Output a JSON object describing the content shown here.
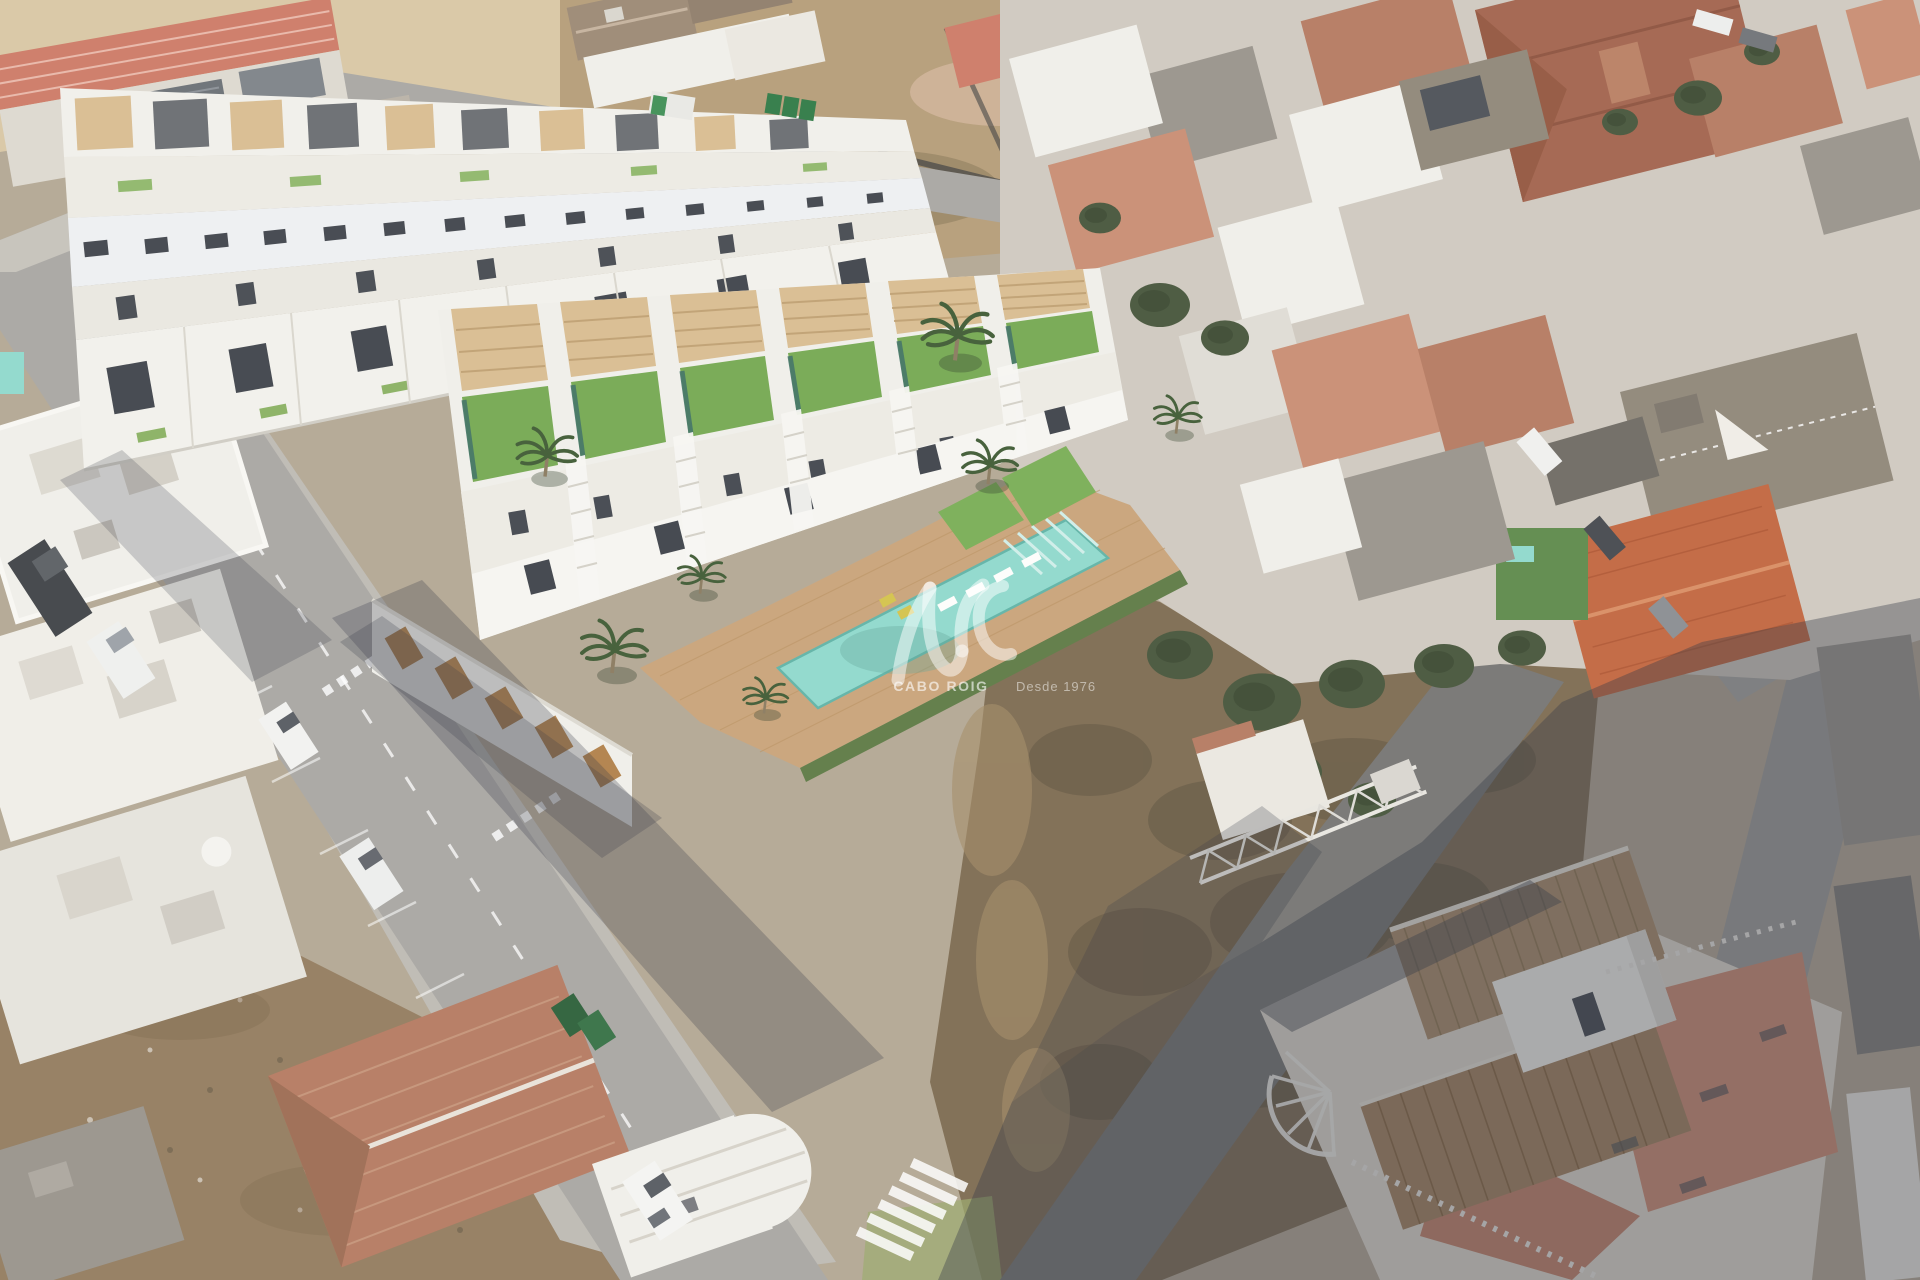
{
  "watermark": {
    "monogram": "AVS",
    "brand": "CABO ROIG",
    "since": "Desde 1976"
  },
  "scene": {
    "description": "Aerial composite: 3D render of a new white townhouse development with green roofs, communal pool and wooden sun deck, inserted into an aerial photo of an existing Spanish coastal town with terracotta roofs, asphalt streets, parked cars, empty dirt plots and palm trees.",
    "new_townhouse_units": 6,
    "pools_visible": 2,
    "palm_trees": 7
  },
  "palette": {
    "sand": "#d8c7a4",
    "dirt": "#b59c78",
    "dirt_dark": "#8d7858",
    "scrub": "#7d6b51",
    "scrub_dark": "#5e523e",
    "dirt_bl": "#937c5e",
    "road": "#a8a6a2",
    "road_dark": "#757472",
    "sidewalk": "#c6c2ba",
    "parking": "#bdbab3",
    "marking": "#ffffff",
    "render_white": "#f0efe9",
    "render_shade": "#e0ded6",
    "opening": "#42464d",
    "pergola": "#d8bc90",
    "garage_door": "#b08049",
    "lawn": "#74a851",
    "lawn_dark": "#4f7f3e",
    "pool": "#8fd9cc",
    "pool_dark": "#5fb3a6",
    "deck": "#c9a379",
    "hedge": "#5d7a44",
    "terracotta": "#b57a60",
    "terracotta_dark": "#a2634c",
    "terracotta_bright": "#c1663f",
    "terracotta_light": "#c98d72",
    "salmon": "#cd7a66",
    "tile_tan": "#a98a68",
    "pink_terrace": "#cb8a70",
    "roof_gray": "#98938b",
    "roof_brown": "#8f8678",
    "roof_dark": "#6e6a63",
    "tree": "#46553a",
    "tree_dark": "#38452e",
    "shadow": "#2e3340",
    "van_dark": "#3f4246"
  }
}
